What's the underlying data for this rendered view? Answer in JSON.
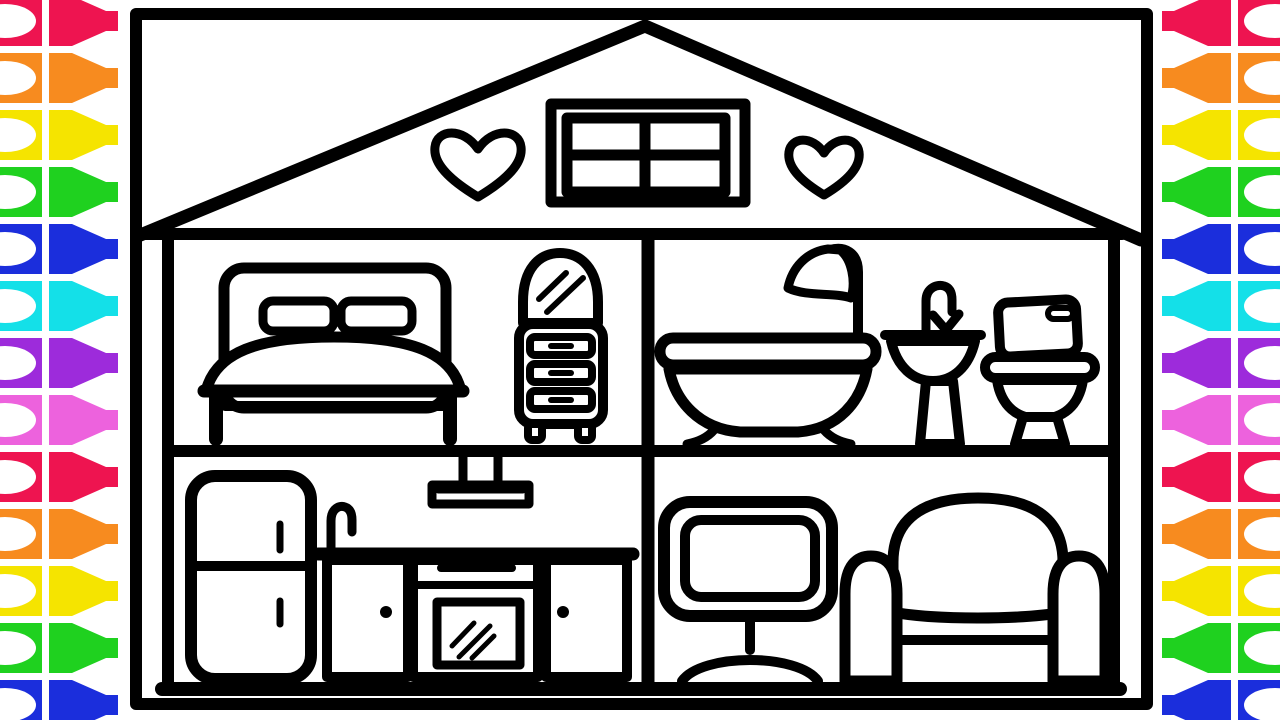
{
  "title": "House cross-section coloring page",
  "palette": {
    "ink": "#000000",
    "paper": "#ffffff"
  },
  "crayon_strips": {
    "colors": [
      "#EE1450",
      "#F78B1F",
      "#F5E400",
      "#1FD11F",
      "#1B2EDC",
      "#14E0E8",
      "#9D2BDB",
      "#ED62DD"
    ],
    "count_per_side": 13,
    "period_px": 57,
    "top_offset_px": -4,
    "sides": [
      "left",
      "right"
    ]
  },
  "house": {
    "attic": {
      "items": [
        "four-pane-window",
        "heart-left",
        "heart-right"
      ]
    },
    "rooms": [
      {
        "name": "bedroom",
        "items": [
          "bed",
          "pillows",
          "blanket",
          "dresser-with-mirror"
        ]
      },
      {
        "name": "bathroom",
        "items": [
          "shower-bathtub",
          "pedestal-sink",
          "toilet"
        ]
      },
      {
        "name": "kitchen",
        "items": [
          "ceiling-lamp",
          "refrigerator",
          "sink-cabinet",
          "oven-stove",
          "cabinet"
        ]
      },
      {
        "name": "living-room",
        "items": [
          "television",
          "armchair"
        ]
      }
    ]
  }
}
